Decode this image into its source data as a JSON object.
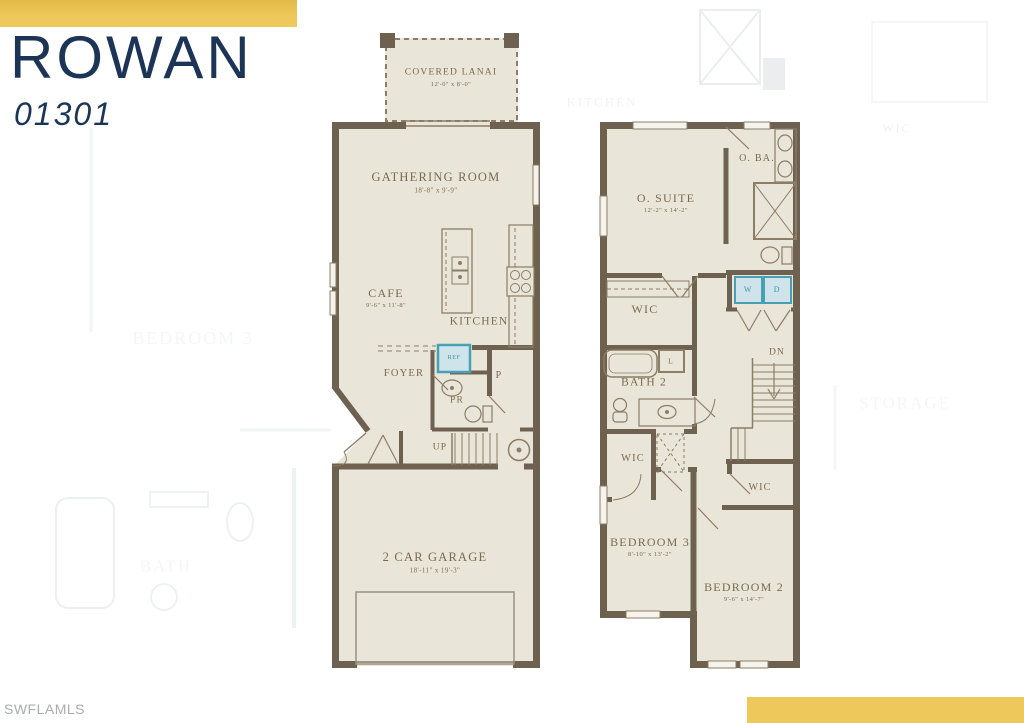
{
  "header": {
    "title": "ROWAN",
    "plan_number": "01301"
  },
  "watermark": "SWFLAMLS",
  "colors": {
    "accent_gold": "#eec85a",
    "title_navy": "#1c3557",
    "wall_brown": "#6e6150",
    "floor_beige": "#e9e5d8",
    "label_brown": "#7b6a4e",
    "appliance_teal": "#49a0b5",
    "appliance_fill": "#cfe4ea"
  },
  "first_floor": {
    "covered_lanai": {
      "name": "COVERED LANAI",
      "dims": "12'-0\" x 8'-0\""
    },
    "gathering_room": {
      "name": "GATHERING ROOM",
      "dims": "18'-8\" x 9'-9\""
    },
    "cafe": {
      "name": "CAFE",
      "dims": "9'-6\" x 11'-8\""
    },
    "kitchen": {
      "name": "KITCHEN"
    },
    "foyer": {
      "name": "FOYER"
    },
    "pantry": {
      "name": "P"
    },
    "powder_room": {
      "name": "PR"
    },
    "stairs_up": {
      "name": "UP"
    },
    "refrigerator": {
      "name": "REF"
    },
    "garage": {
      "name": "2 CAR GARAGE",
      "dims": "18'-11\" x 19'-3\""
    }
  },
  "second_floor": {
    "owner_suite": {
      "name": "O. SUITE",
      "dims": "12'-2\" x 14'-2\""
    },
    "owner_bath": {
      "name": "O. BA."
    },
    "wic_owner": {
      "name": "WIC"
    },
    "washer": {
      "name": "W"
    },
    "dryer": {
      "name": "D"
    },
    "bath2": {
      "name": "BATH 2"
    },
    "linen": {
      "name": "L"
    },
    "stairs_down": {
      "name": "DN"
    },
    "wic_bedroom3": {
      "name": "WIC"
    },
    "wic_bedroom2": {
      "name": "WIC"
    },
    "bedroom3": {
      "name": "BEDROOM 3",
      "dims": "8'-10\" x 13'-2\""
    },
    "bedroom2": {
      "name": "BEDROOM 2",
      "dims": "9'-6\" x 14'-7\""
    }
  },
  "background_plan": {
    "kitchen_label": "KITCHEN",
    "wic_label": "WIC",
    "bedroom3_label": "BEDROOM 3",
    "storage_label": "STORAGE",
    "bath_label": "BATH"
  }
}
